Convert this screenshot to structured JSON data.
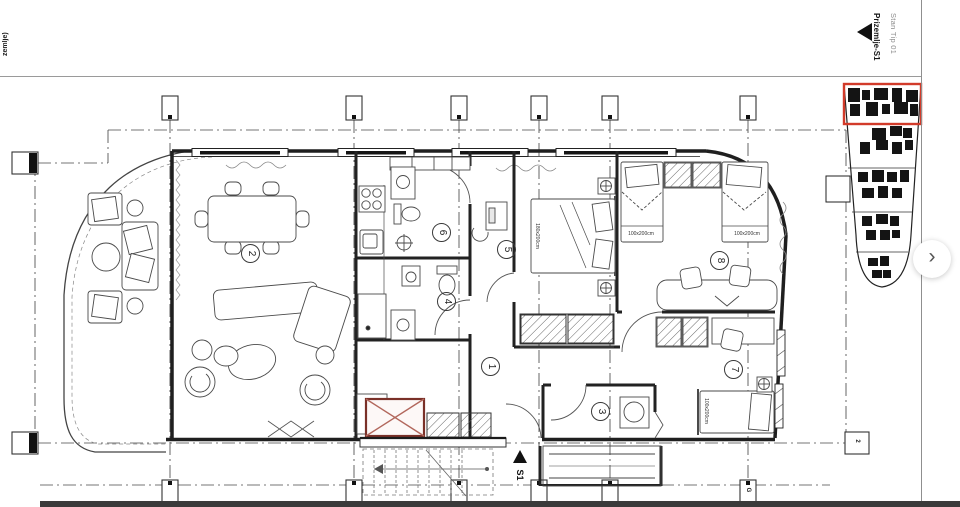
{
  "page": {
    "side_label": "zemlje)"
  },
  "header": {
    "plan_type": "Stan Tip 01",
    "floor_name": "Prizemlje-S1"
  },
  "carousel": {
    "next_symbol": "›"
  },
  "plan": {
    "section_marker": "S1",
    "grid_letters": {
      "g": "G",
      "two": "2"
    },
    "room_numbers": [
      "1",
      "2",
      "3",
      "4",
      "5",
      "6",
      "7",
      "8"
    ],
    "bed_sizes": {
      "master": "180x200cm",
      "single_a": "100x200cm",
      "single_b": "100x200cm",
      "single_c": "100x200cm"
    },
    "colors": {
      "shaft_border": "#7a3028",
      "shaft_cross": "#b2675c",
      "minimap_highlight": "#d23b2a"
    }
  }
}
